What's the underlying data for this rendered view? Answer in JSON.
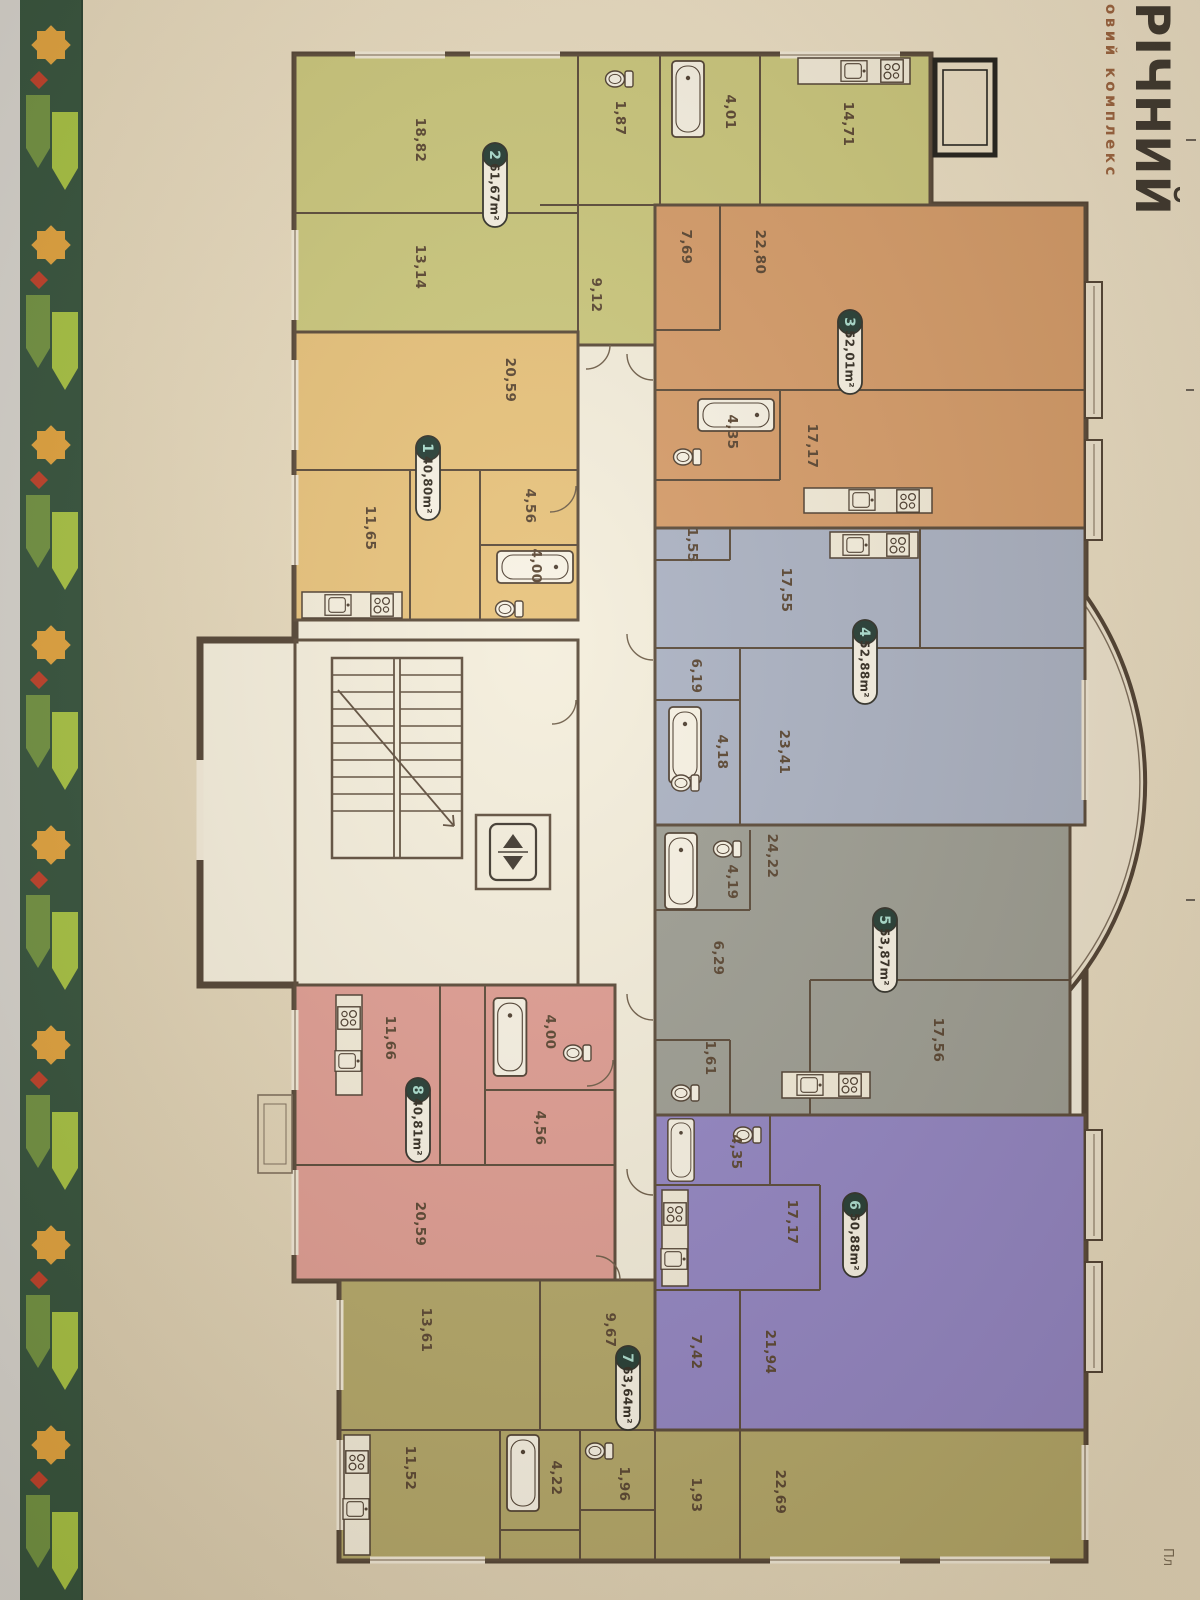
{
  "page": {
    "brand_title": "РІЧНИЙ",
    "brand_subtitle": "овий комплекс",
    "corner_text": "Пл"
  },
  "palette": {
    "apt1": "#e7c179",
    "apt2": "#cac77b",
    "apt3": "#d59a67",
    "apt4": "#a9b1c4",
    "apt5": "#9b9c93",
    "apt6": "#9083c5",
    "apt7": "#b2a667",
    "apt8": "#df9b92",
    "paper": "#e9dcc1",
    "building_base": "#f4eedd",
    "wall": "#4d3e30",
    "ornament_green": "#2f4f3a",
    "ornament_orange": "#e3a33c",
    "ornament_leaf_light": "#a6c341",
    "ornament_leaf_dark": "#6e9140",
    "ornament_red": "#bf3c27",
    "badge_circle": "#1f3831",
    "badge_number": "#a9dfd1"
  },
  "apartments": [
    {
      "number": "1",
      "area": "40,80m²",
      "rooms": {
        "living": "20,59",
        "kitchen": "11,65",
        "hall": "4,56",
        "bath": "4,00"
      }
    },
    {
      "number": "2",
      "area": "61,67m²",
      "rooms": {
        "living": "18,82",
        "bedroom": "13,14",
        "kitchen": "14,71",
        "bath": "4,01",
        "wc": "1,87",
        "hall": "9,12"
      }
    },
    {
      "number": "3",
      "area": "52,01m²",
      "rooms": {
        "living": "22,80",
        "kitchen": "17,17",
        "hall": "7,69",
        "bath": "4,35"
      }
    },
    {
      "number": "4",
      "area": "52,88m²",
      "rooms": {
        "living": "23,41",
        "kitchen": "17,55",
        "hall": "6,19",
        "bath": "4,18",
        "wc": "1,55"
      }
    },
    {
      "number": "5",
      "area": "53,87m²",
      "rooms": {
        "living": "24,22",
        "kitchen": "17,56",
        "hall": "6,29",
        "bath": "4,19",
        "wc": "1,61"
      }
    },
    {
      "number": "6",
      "area": "50,88m²",
      "rooms": {
        "living": "21,94",
        "kitchen": "17,17",
        "hall": "7,42",
        "bath": "4,35"
      }
    },
    {
      "number": "7",
      "area": "63,64m²",
      "rooms": {
        "living": "22,69",
        "bedroom": "13,61",
        "kitchen": "11,52",
        "hall": "9,67",
        "bath": "4,22",
        "wc": "1,96",
        "storage": "1,93"
      }
    },
    {
      "number": "8",
      "area": "40,81m²",
      "rooms": {
        "living": "20,59",
        "kitchen": "11,66",
        "hall": "4,56",
        "bath": "4,00"
      }
    }
  ]
}
